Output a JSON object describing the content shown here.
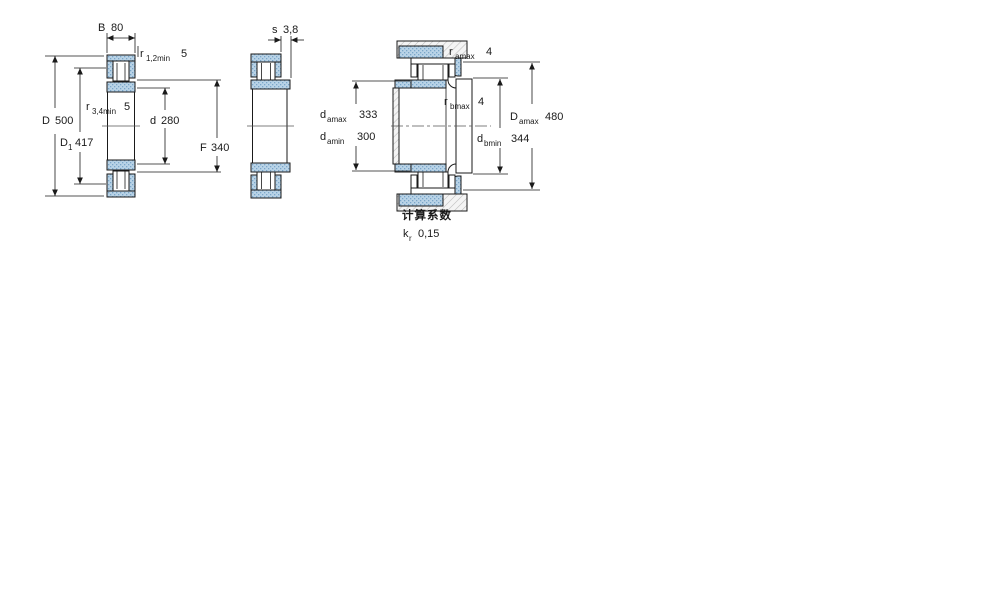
{
  "figure": {
    "left": {
      "b_label": "B",
      "b_value": "80",
      "r12_base": "r",
      "r12_sub": "1,2min",
      "r12_value": "5",
      "d_big_label": "D",
      "d_big_value": "500",
      "d1_base": "D",
      "d1_sub": "1",
      "d1_value": "417",
      "r34_base": "r",
      "r34_sub": "3,4min",
      "r34_value": "5",
      "d_small_label": "d",
      "d_small_value": "280",
      "f_label": "F",
      "f_value": "340"
    },
    "middle": {
      "s_label": "s",
      "s_value": "3,8"
    },
    "right": {
      "ramax_base": "r",
      "ramax_sub": "amax",
      "ramax_value": "4",
      "rbmax_base": "r",
      "rbmax_sub": "bmax",
      "rbmax_value": "4",
      "damax_base": "d",
      "damax_sub": "amax",
      "damax_value": "333",
      "damin_base": "d",
      "damin_sub": "amin",
      "damin_value": "300",
      "Damax_base": "D",
      "Damax_sub": "amax",
      "Damax_value": "480",
      "dbmin_base": "d",
      "dbmin_sub": "bmin",
      "dbmin_value": "344"
    },
    "factors": {
      "title": "计算系数",
      "kr_base": "k",
      "kr_sub": "r",
      "kr_value": "0,15"
    }
  },
  "colors": {
    "ring_fill": "#b9d3e7",
    "ring_dot": "#7ba6c9",
    "hatch_line": "#bbbbbb",
    "line": "#1a1a1a"
  }
}
